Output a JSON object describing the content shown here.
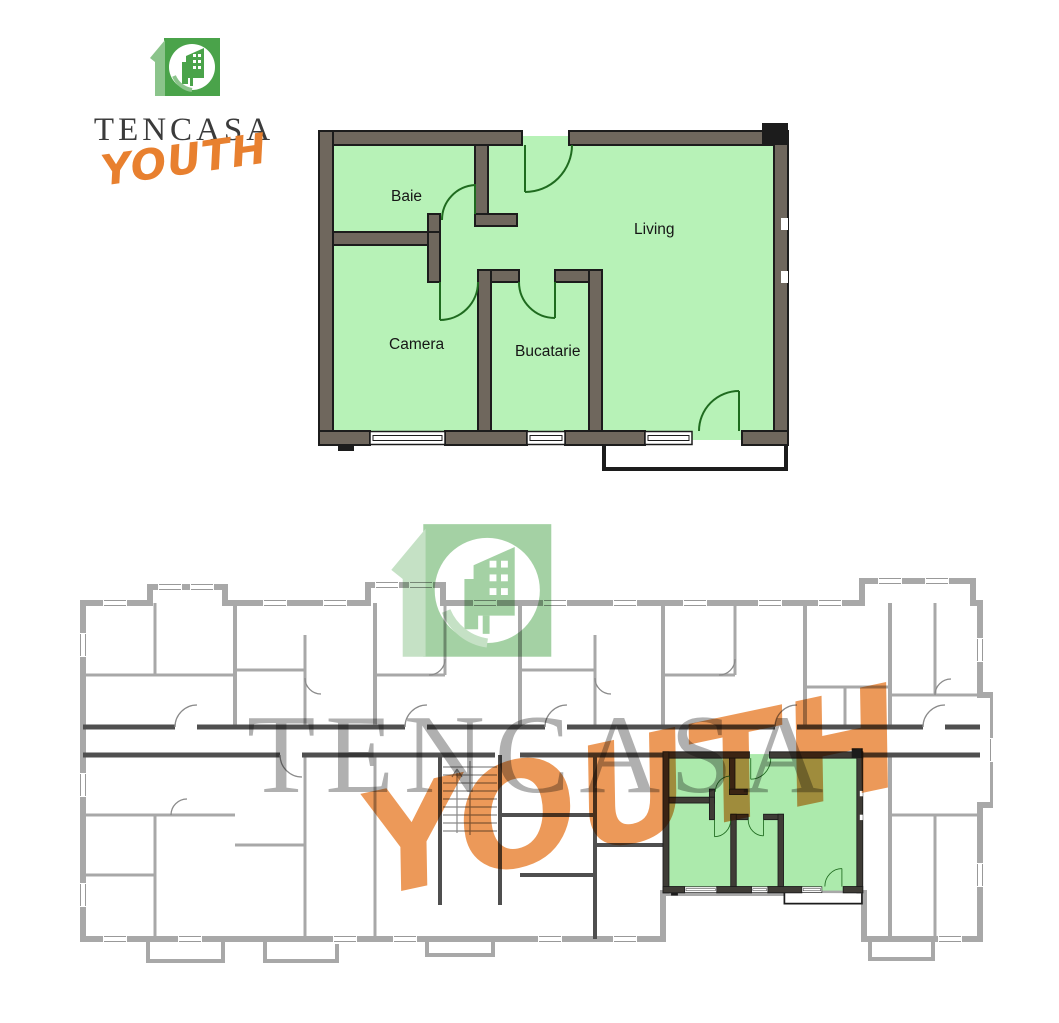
{
  "logo": {
    "brand": "TENCASA",
    "sub": "YOUTH",
    "icon": "tencasa-10-building-logo"
  },
  "apartment_plan": {
    "rooms": [
      {
        "label": "Baie"
      },
      {
        "label": "Living"
      },
      {
        "label": "Camera"
      },
      {
        "label": "Bucatarie"
      }
    ]
  },
  "building_plan": {
    "watermark_brand": "TENCASA",
    "watermark_sub": "YOUTH"
  },
  "colors": {
    "room_green": "#b7f2b7",
    "wall_taupe": "#6f675d",
    "arc_green": "#1f6b1f",
    "outline": "#1c1c1c",
    "bldg_wall": "#a8a8a8",
    "bldg_dark": "#4f4f4f",
    "hl_wall": "#3f3c36",
    "hl_room": "#aceaac",
    "brand_text": "#3b3b3b",
    "brand_orange": "#e8802f",
    "logo_green": "#4aa34a",
    "logo_green_light": "#8bc48b",
    "wm_gray": "#4f4f4f"
  }
}
